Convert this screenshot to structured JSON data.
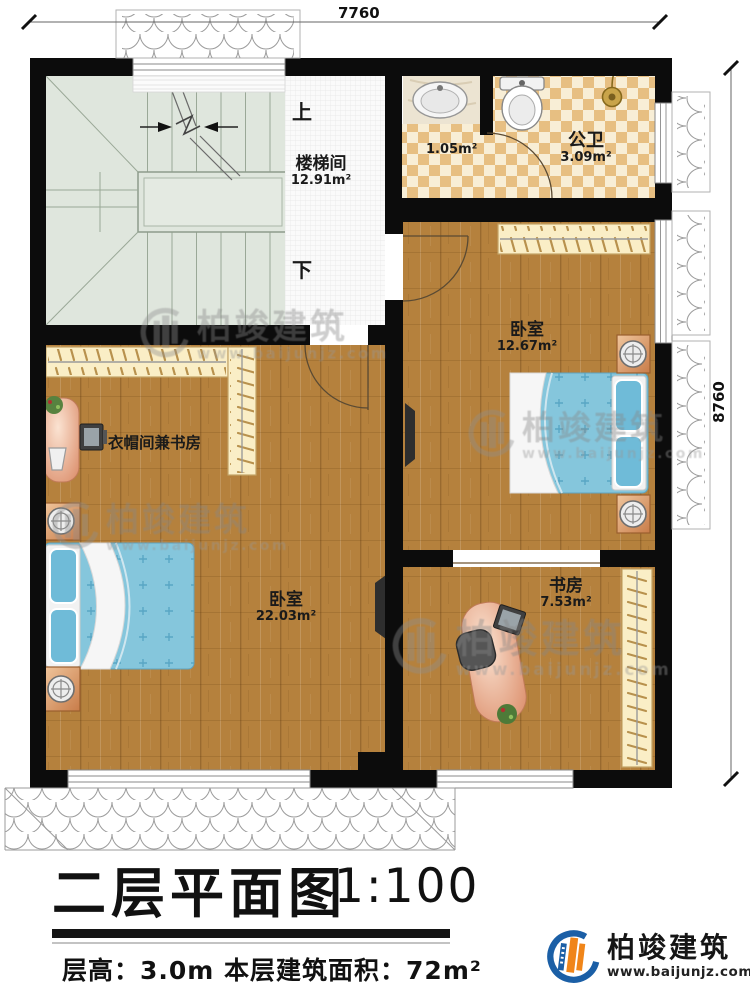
{
  "dimensions": {
    "top": "7760",
    "right": "8760"
  },
  "rooms": {
    "stairwell": {
      "name": "楼梯间",
      "area": "12.91m²",
      "up_label": "上",
      "down_label": "下"
    },
    "bath": {
      "name": "公卫",
      "area": "3.09m²",
      "lobby_area": "1.05m²"
    },
    "bedroom_right": {
      "name": "卧室",
      "area": "12.67m²"
    },
    "cloakroom": {
      "name": "衣帽间兼书房"
    },
    "bedroom_main": {
      "name": "卧室",
      "area": "22.03m²"
    },
    "study": {
      "name": "书房",
      "area": "7.53m²"
    }
  },
  "title_block": {
    "title": "二层平面图",
    "scale": "1:100",
    "floor_info": "层高：3.0m  本层建筑面积：72m²"
  },
  "watermark": {
    "brand": "柏竣建筑",
    "url": "www.baijunjz.com"
  },
  "logo": {
    "brand": "柏竣建筑",
    "url": "www.baijunjz.com"
  },
  "colors": {
    "wall": "#0c0c0c",
    "wood_floor": "#b5813d",
    "checker_dark": "#e7bf82",
    "checker_light": "#f8eed6",
    "stair": "#dfe6dd",
    "wardrobe": "#faeec6",
    "bed_blue": "#85c6dc",
    "logo_blue": "#1b5fa6",
    "logo_orange": "#f08519"
  }
}
